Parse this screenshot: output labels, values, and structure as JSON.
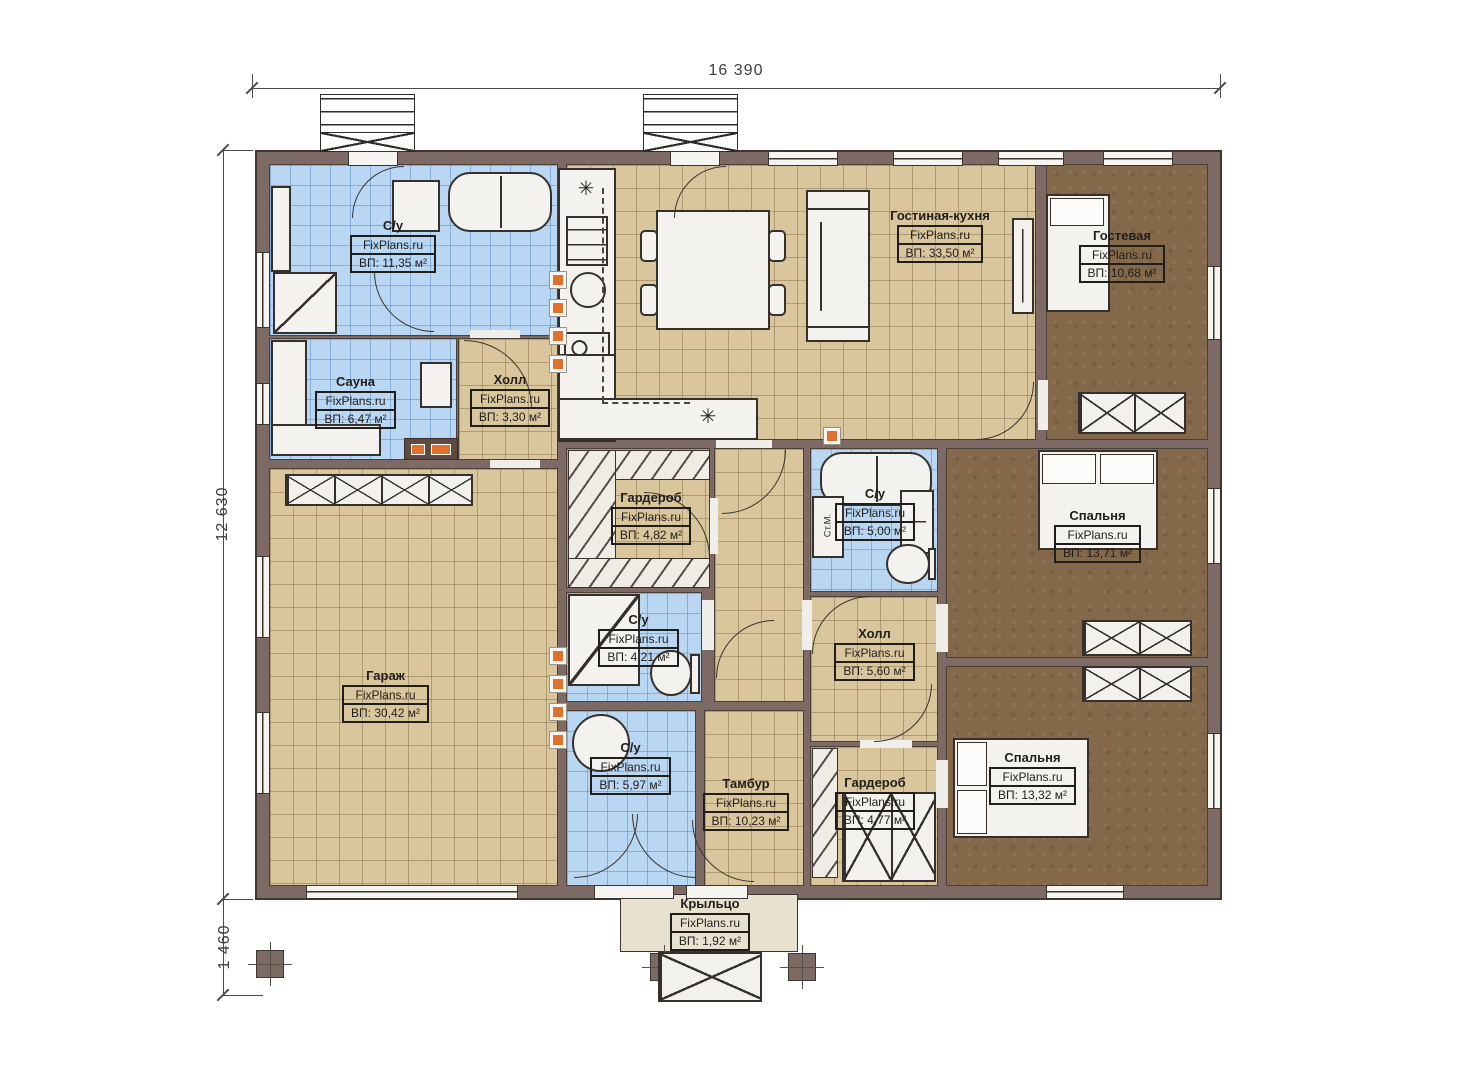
{
  "plan": {
    "watermark": "FixPlans.ru",
    "dimensions": {
      "top": "16 390",
      "left": "12 630",
      "bottom_left": "1 460"
    },
    "labels": {
      "washing_machine": "Ст.М."
    },
    "symbols": {
      "star": "✳"
    },
    "colors": {
      "wall": "#7d6a64",
      "tile_tan": "#d9c69c",
      "tile_blue": "#b9d7f3",
      "carpet": "#83684a",
      "accent_orange": "#e0702c"
    },
    "rooms": [
      {
        "id": "bathroom-1",
        "name": "С/у",
        "area": "ВП: 11,35 м²"
      },
      {
        "id": "sauna",
        "name": "Сауна",
        "area": "ВП: 6,47 м²"
      },
      {
        "id": "hall-1",
        "name": "Холл",
        "area": "ВП: 3,30 м²"
      },
      {
        "id": "living",
        "name": "Гостиная-кухня",
        "area": "ВП: 33,50 м²"
      },
      {
        "id": "guest",
        "name": "Гостевая",
        "area": "ВП: 10,68 м²"
      },
      {
        "id": "wardrobe-1",
        "name": "Гардероб",
        "area": "ВП: 4,82 м²"
      },
      {
        "id": "bathroom-2",
        "name": "С/у",
        "area": "ВП: 5,00 м²"
      },
      {
        "id": "bedroom-1",
        "name": "Спальня",
        "area": "ВП: 13,71 м²"
      },
      {
        "id": "garage",
        "name": "Гараж",
        "area": "ВП: 30,42 м²"
      },
      {
        "id": "bathroom-3",
        "name": "С/у",
        "area": "ВП: 4,21 м²"
      },
      {
        "id": "hall-2",
        "name": "Холл",
        "area": "ВП: 5,60 м²"
      },
      {
        "id": "bathroom-4",
        "name": "С/у",
        "area": "ВП: 5,97 м²"
      },
      {
        "id": "tambour",
        "name": "Тамбур",
        "area": "ВП: 10,23 м²"
      },
      {
        "id": "wardrobe-2",
        "name": "Гардероб",
        "area": "ВП: 4,77 м²"
      },
      {
        "id": "bedroom-2",
        "name": "Спальня",
        "area": "ВП: 13,32 м²"
      },
      {
        "id": "porch",
        "name": "Крыльцо",
        "area": "ВП: 1,92 м²"
      }
    ]
  }
}
